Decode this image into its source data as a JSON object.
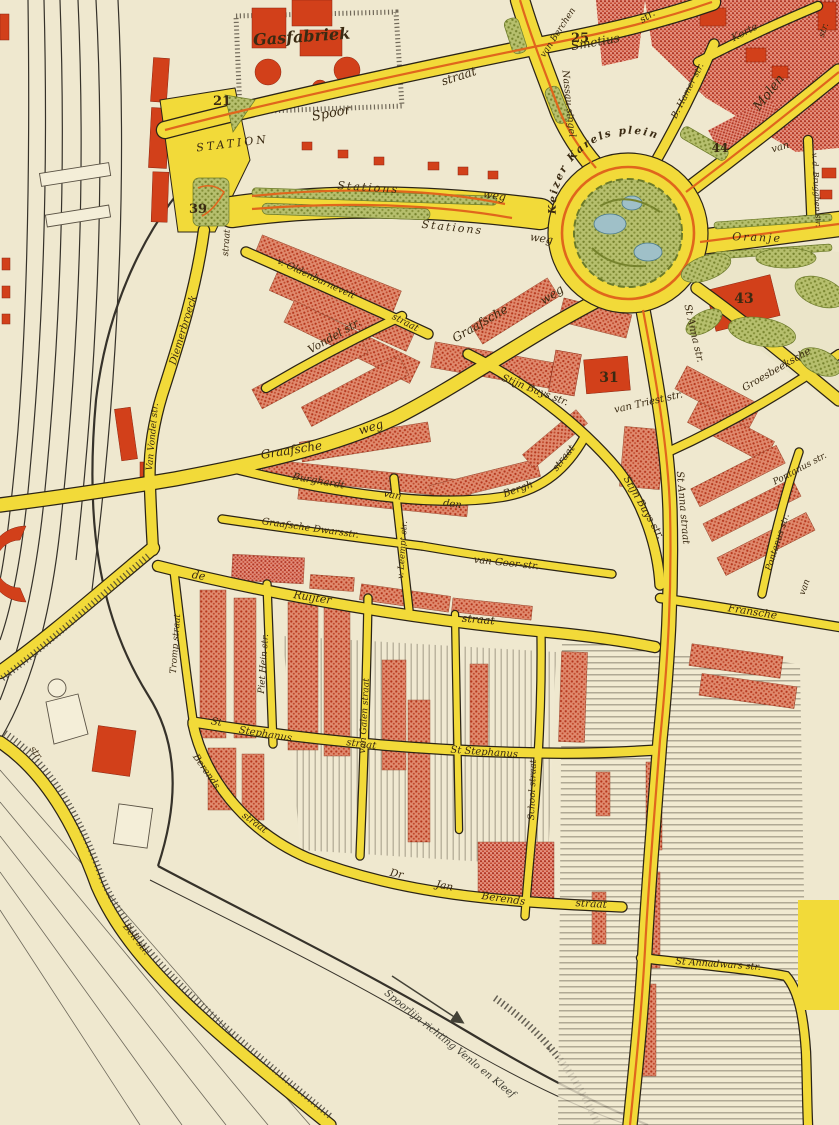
{
  "map": {
    "title": "city-map-scan",
    "street_labels": [
      {
        "text": "Gasfabriek",
        "x": 302,
        "y": 42,
        "rot": -4,
        "size": 16,
        "bold": true
      },
      {
        "text": "STATION",
        "x": 233,
        "y": 147,
        "rot": -7,
        "size": 11,
        "ls": 3
      },
      {
        "text": "Spoor",
        "x": 332,
        "y": 117,
        "rot": -11,
        "size": 13
      },
      {
        "text": "straat",
        "x": 460,
        "y": 80,
        "rot": -18,
        "size": 12
      },
      {
        "text": "van Berchen",
        "x": 560,
        "y": 34,
        "rot": -57,
        "size": 9
      },
      {
        "text": "Smetius",
        "x": 596,
        "y": 46,
        "rot": -10,
        "size": 12
      },
      {
        "text": "str.",
        "x": 649,
        "y": 19,
        "rot": -33,
        "size": 10
      },
      {
        "text": "Nassau singel",
        "x": 566,
        "y": 104,
        "rot": 84,
        "size": 9.5
      },
      {
        "text": "B. Hamer str.",
        "x": 690,
        "y": 92,
        "rot": -63,
        "size": 9
      },
      {
        "text": "Korte",
        "x": 746,
        "y": 35,
        "rot": -27,
        "size": 10
      },
      {
        "text": "Molen",
        "x": 772,
        "y": 95,
        "rot": -52,
        "size": 13
      },
      {
        "text": "str.",
        "x": 826,
        "y": 31,
        "rot": -70,
        "size": 9
      },
      {
        "text": "van",
        "x": 781,
        "y": 150,
        "rot": -16,
        "size": 10
      },
      {
        "text": "v. d. Brugghen str.",
        "x": 814,
        "y": 190,
        "rot": 87,
        "size": 8
      },
      {
        "text": "Stations",
        "x": 368,
        "y": 191,
        "rot": 4,
        "size": 11,
        "ls": 2
      },
      {
        "text": "weg",
        "x": 494,
        "y": 199,
        "rot": 9,
        "size": 11
      },
      {
        "text": "Stations",
        "x": 452,
        "y": 231,
        "rot": 6,
        "size": 11,
        "ls": 2
      },
      {
        "text": "weg",
        "x": 541,
        "y": 242,
        "rot": 9,
        "size": 11
      },
      {
        "text": "Oranje",
        "x": 757,
        "y": 241,
        "rot": 2,
        "size": 11,
        "ls": 2
      },
      {
        "text": "St Anna str.",
        "x": 691,
        "y": 334,
        "rot": 77,
        "size": 10
      },
      {
        "text": "St Anna straat",
        "x": 680,
        "y": 508,
        "rot": 85,
        "size": 10
      },
      {
        "text": "St Annadwars str.",
        "x": 718,
        "y": 967,
        "rot": 4,
        "size": 9.5
      },
      {
        "text": "Groesbeeksche",
        "x": 778,
        "y": 372,
        "rot": -30,
        "size": 10
      },
      {
        "text": "Graafsche",
        "x": 482,
        "y": 327,
        "rot": -30,
        "size": 12
      },
      {
        "text": "weg",
        "x": 554,
        "y": 298,
        "rot": -33,
        "size": 12
      },
      {
        "text": "Graafsche",
        "x": 292,
        "y": 454,
        "rot": -9,
        "size": 12
      },
      {
        "text": "weg",
        "x": 372,
        "y": 431,
        "rot": -17,
        "size": 12
      },
      {
        "text": "v. Oldenbarnevelt",
        "x": 315,
        "y": 281,
        "rot": 25,
        "size": 9.5
      },
      {
        "text": "straat",
        "x": 404,
        "y": 325,
        "rot": 27,
        "size": 9.5
      },
      {
        "text": "Vondel str.",
        "x": 336,
        "y": 339,
        "rot": -30,
        "size": 11
      },
      {
        "text": "straat",
        "x": 229,
        "y": 243,
        "rot": -86,
        "size": 9
      },
      {
        "text": "Diemerbroeck",
        "x": 186,
        "y": 331,
        "rot": -73,
        "size": 10
      },
      {
        "text": "Van Vondel str.",
        "x": 155,
        "y": 437,
        "rot": -85,
        "size": 9
      },
      {
        "text": "Burghardt",
        "x": 318,
        "y": 484,
        "rot": 10,
        "size": 10
      },
      {
        "text": "van",
        "x": 392,
        "y": 498,
        "rot": 11,
        "size": 10
      },
      {
        "text": "den",
        "x": 452,
        "y": 507,
        "rot": 8,
        "size": 10
      },
      {
        "text": "Bergh",
        "x": 519,
        "y": 492,
        "rot": -20,
        "size": 10
      },
      {
        "text": "straat",
        "x": 566,
        "y": 460,
        "rot": -52,
        "size": 10
      },
      {
        "text": "Stijn Buys str.",
        "x": 534,
        "y": 393,
        "rot": 21,
        "size": 10
      },
      {
        "text": "Stijn Buys str.",
        "x": 641,
        "y": 509,
        "rot": 60,
        "size": 10
      },
      {
        "text": "van Triest str.",
        "x": 649,
        "y": 405,
        "rot": -13,
        "size": 10
      },
      {
        "text": "van Goor-str.",
        "x": 506,
        "y": 566,
        "rot": 6,
        "size": 10
      },
      {
        "text": "Graafsche Dwarsstr.",
        "x": 310,
        "y": 531,
        "rot": 8,
        "size": 9.5
      },
      {
        "text": "v. Leempt str.",
        "x": 405,
        "y": 550,
        "rot": -86,
        "size": 8.5
      },
      {
        "text": "de",
        "x": 198,
        "y": 579,
        "rot": 10,
        "size": 11
      },
      {
        "text": "Ruijter",
        "x": 312,
        "y": 601,
        "rot": 9,
        "size": 11
      },
      {
        "text": "straat",
        "x": 478,
        "y": 623,
        "rot": 5,
        "size": 11
      },
      {
        "text": "Tromp straat",
        "x": 178,
        "y": 644,
        "rot": -86,
        "size": 9
      },
      {
        "text": "Piet Hein str.",
        "x": 266,
        "y": 664,
        "rot": -86,
        "size": 9
      },
      {
        "text": "van Galen straat",
        "x": 367,
        "y": 716,
        "rot": -87,
        "size": 9
      },
      {
        "text": "School straat",
        "x": 535,
        "y": 790,
        "rot": -88,
        "size": 9
      },
      {
        "text": "St",
        "x": 216,
        "y": 725,
        "rot": 9,
        "size": 10
      },
      {
        "text": "Stephanus",
        "x": 265,
        "y": 737,
        "rot": 9,
        "size": 10
      },
      {
        "text": "straat",
        "x": 361,
        "y": 747,
        "rot": 7,
        "size": 10
      },
      {
        "text": "St Stephanus",
        "x": 484,
        "y": 755,
        "rot": 4,
        "size": 10
      },
      {
        "text": "Berends",
        "x": 204,
        "y": 773,
        "rot": 55,
        "size": 9.5
      },
      {
        "text": "straat",
        "x": 253,
        "y": 825,
        "rot": 36,
        "size": 9.5
      },
      {
        "text": "Dr",
        "x": 396,
        "y": 877,
        "rot": 11,
        "size": 10.5
      },
      {
        "text": "Jan",
        "x": 444,
        "y": 889,
        "rot": 11,
        "size": 10.5
      },
      {
        "text": "Berends",
        "x": 503,
        "y": 902,
        "rot": 8,
        "size": 10.5
      },
      {
        "text": "straat",
        "x": 591,
        "y": 907,
        "rot": 3,
        "size": 10.5
      },
      {
        "text": "Fransche",
        "x": 752,
        "y": 615,
        "rot": 9,
        "size": 10.5
      },
      {
        "text": "Pontanus str.",
        "x": 801,
        "y": 471,
        "rot": -28,
        "size": 9
      },
      {
        "text": "Pontanus str.",
        "x": 780,
        "y": 543,
        "rot": -72,
        "size": 9
      },
      {
        "text": "van",
        "x": 807,
        "y": 588,
        "rot": -70,
        "size": 9
      },
      {
        "text": "Bell str.",
        "x": 134,
        "y": 941,
        "rot": 52,
        "size": 9.5
      },
      {
        "text": "str.",
        "x": 34,
        "y": 755,
        "rot": 52,
        "size": 9.5
      }
    ],
    "roundabout_label": {
      "text": "Keizer Karels plein",
      "size": 10.5,
      "ls": 2
    },
    "railway_note": {
      "text": "Spoorlijn richting Venlo en Kleef",
      "x": 448,
      "y": 1046,
      "rot": 39,
      "size": 10
    },
    "plot_numbers": [
      {
        "text": "21",
        "x": 222,
        "y": 105,
        "color": "red",
        "size": 13
      },
      {
        "text": "39",
        "x": 198,
        "y": 213,
        "color": "red",
        "size": 13
      },
      {
        "text": "25",
        "x": 580,
        "y": 42,
        "color": "dark",
        "size": 13
      },
      {
        "text": "44",
        "x": 720,
        "y": 152,
        "color": "dark",
        "size": 12
      },
      {
        "text": "43",
        "x": 744,
        "y": 303,
        "color": "red",
        "size": 14
      },
      {
        "text": "31",
        "x": 609,
        "y": 382,
        "color": "red",
        "size": 14
      }
    ],
    "palette": {
      "paper": "#efe8cf",
      "street_yellow": "#f2da39",
      "casing_black": "#2b2417",
      "tram_orange": "#e0661c",
      "building_red": "#d2401a",
      "rowhouse_pink": "#e08a6e",
      "park_green": "#b3bd6a",
      "pond_blue": "#9fc0c8",
      "label_ink": "#3a2a12",
      "number_red": "#a31605",
      "number_dark": "#2c2c24"
    }
  }
}
